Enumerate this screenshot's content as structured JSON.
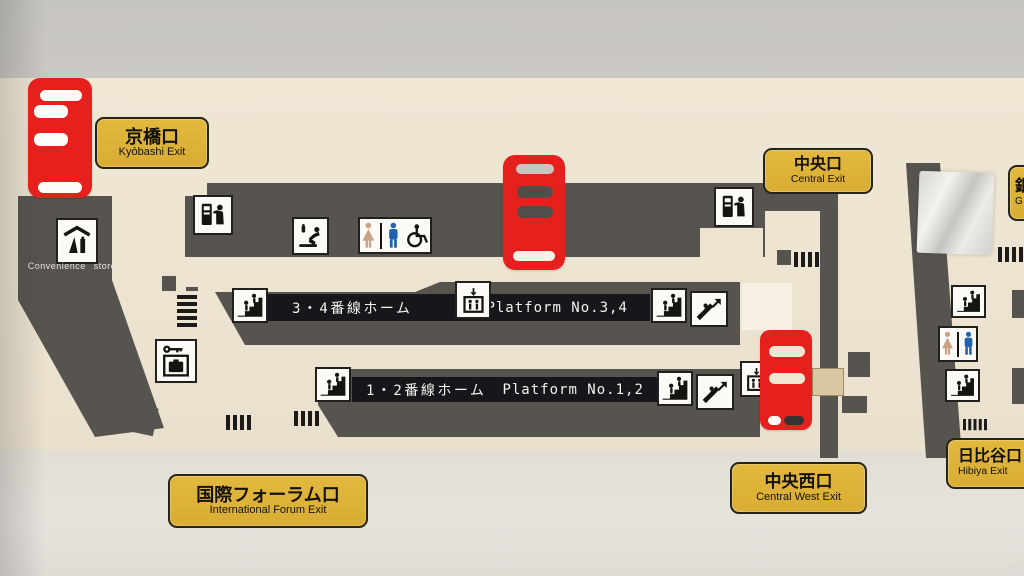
{
  "scene": {
    "type": "station-floor-map-photo",
    "description": "Photograph of a Japanese railway station floor map showing platforms, exits, ticket gates and facility pictograms"
  },
  "colors": {
    "ticket_gate_red": "#e5201d",
    "exit_sign_gold": "#ddb23a",
    "structure_dark_gray": "#57544f",
    "platform_bar_black": "#17161a",
    "floor_cream": "#ece3d0",
    "wall_gray": "#c8c5c0",
    "restroom_woman": "#c9a184",
    "restroom_man": "#1f63b0"
  },
  "exits": [
    {
      "jp": "京橋口",
      "en": "Kyōbashi Exit"
    },
    {
      "jp": "中央口",
      "en": "Central Exit"
    },
    {
      "jp": "国際フォーラム口",
      "en": "International Forum Exit"
    },
    {
      "jp": "中央西口",
      "en": "Central West Exit"
    },
    {
      "jp": "日比谷口",
      "en": "Hibiya Exit"
    },
    {
      "jp": "銀",
      "en": "G"
    }
  ],
  "platforms": [
    {
      "jp": "3・4番線ホーム",
      "en": "Platform No.3,4"
    },
    {
      "jp": "1・2番線ホーム",
      "en": "Platform No.1,2"
    }
  ],
  "facilities": {
    "convenience_store": "Convenience store"
  },
  "icons": {
    "ticket_gate": "ticket-gate-symbol",
    "ticket_machine": "ticket-machine-icon",
    "baby_changing": "baby-changing-icon",
    "restroom": "restroom-icon",
    "wheelchair": "wheelchair-accessible-icon",
    "stairs": "stairs-icon",
    "escalator": "escalator-icon",
    "elevator": "elevator-icon",
    "coin_locker": "coin-locker-icon",
    "convenience_store": "convenience-store-icon"
  }
}
